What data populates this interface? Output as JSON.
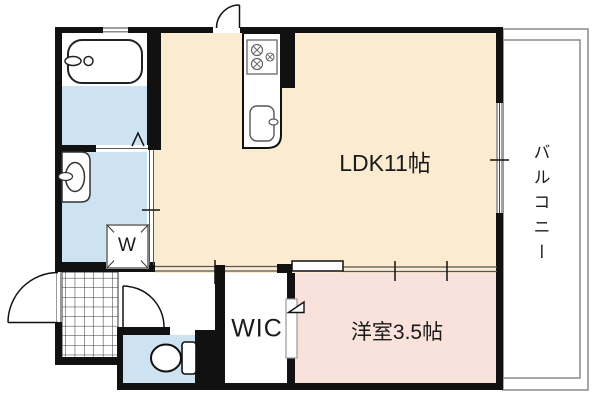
{
  "floorplan": {
    "rooms": {
      "ldk": {
        "label": "LDK11帖"
      },
      "western": {
        "label": "洋室3.5帖"
      },
      "wic": {
        "label": "WIC"
      },
      "balcony": {
        "label": "バルコニー"
      },
      "washer_pan": {
        "label": "W"
      }
    },
    "colors": {
      "ldk_floor": "#faebd1",
      "western_floor": "#f9e2db",
      "wet_floor": "#cde3f2",
      "wall": "#111111",
      "balcony_line": "#8a8a8a",
      "fixture_line": "#444444"
    }
  }
}
